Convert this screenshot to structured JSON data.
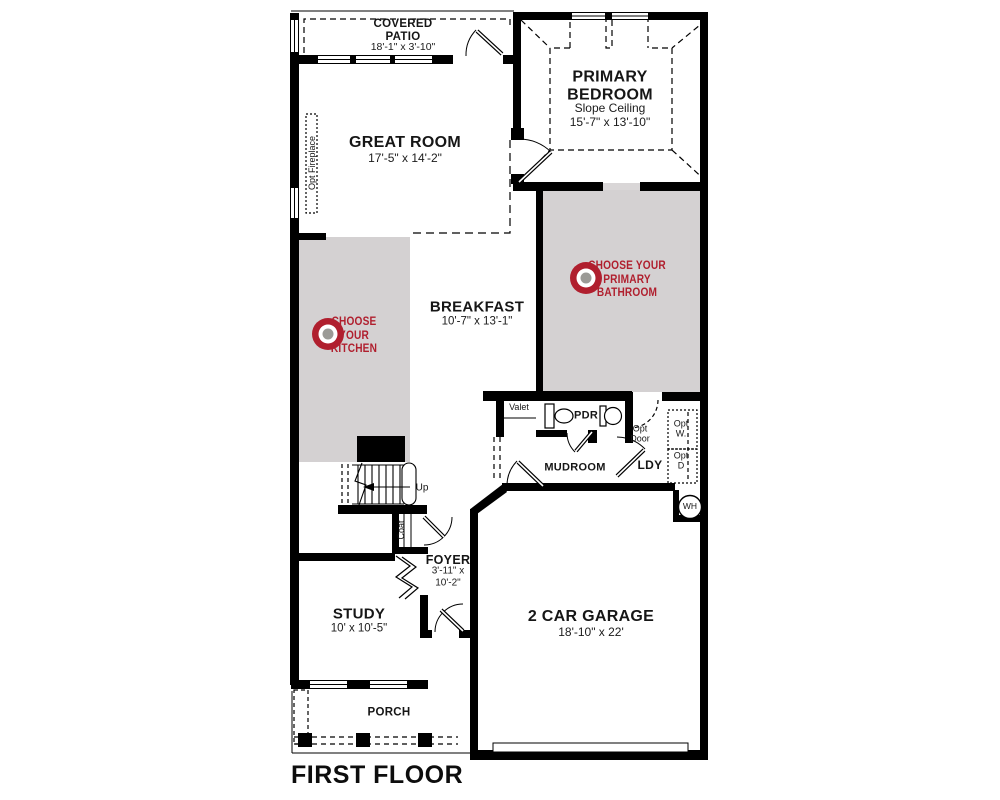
{
  "plan_title": "FIRST FLOOR",
  "colors": {
    "wall": "#000000",
    "room_fill": "#d4d1d2",
    "accent_red": "#b01f2e",
    "target_center": "#9b9a96"
  },
  "rooms": {
    "covered_patio": {
      "name": "COVERED PATIO",
      "dims": "18'-1\" x 3'-10\""
    },
    "great_room": {
      "name": "GREAT ROOM",
      "dims": "17'-5\" x 14'-2\""
    },
    "primary_bedroom": {
      "name": "PRIMARY BEDROOM",
      "note": "Slope Ceiling",
      "dims": "15'-7\" x 13'-10\""
    },
    "breakfast": {
      "name": "BREAKFAST",
      "dims": "10'-7\" x 13'-1\""
    },
    "foyer": {
      "name": "FOYER",
      "dims": "3'-11\" x 10'-2\""
    },
    "study": {
      "name": "STUDY",
      "dims": "10' x 10'-5\""
    },
    "garage": {
      "name": "2 CAR GARAGE",
      "dims": "18'-10\" x 22'"
    },
    "porch": {
      "name": "PORCH"
    },
    "mudroom": {
      "name": "MUDROOM"
    },
    "powder_room": {
      "name": "PDR"
    },
    "laundry": {
      "name": "LDY"
    }
  },
  "hotspots": {
    "kitchen": {
      "label": "CHOOSE YOUR KITCHEN"
    },
    "primary_bathroom": {
      "label": "CHOOSE YOUR PRIMARY BATHROOM"
    }
  },
  "annotations": {
    "valet": "Valet",
    "opt_door": "Opt Door",
    "opt_washer": "Opt W.",
    "opt_dryer": "Opt D",
    "water_heater": "WH",
    "stairs_up": "Up",
    "coat": "Coat",
    "opt_fireplace": "Opt Fireplace"
  }
}
